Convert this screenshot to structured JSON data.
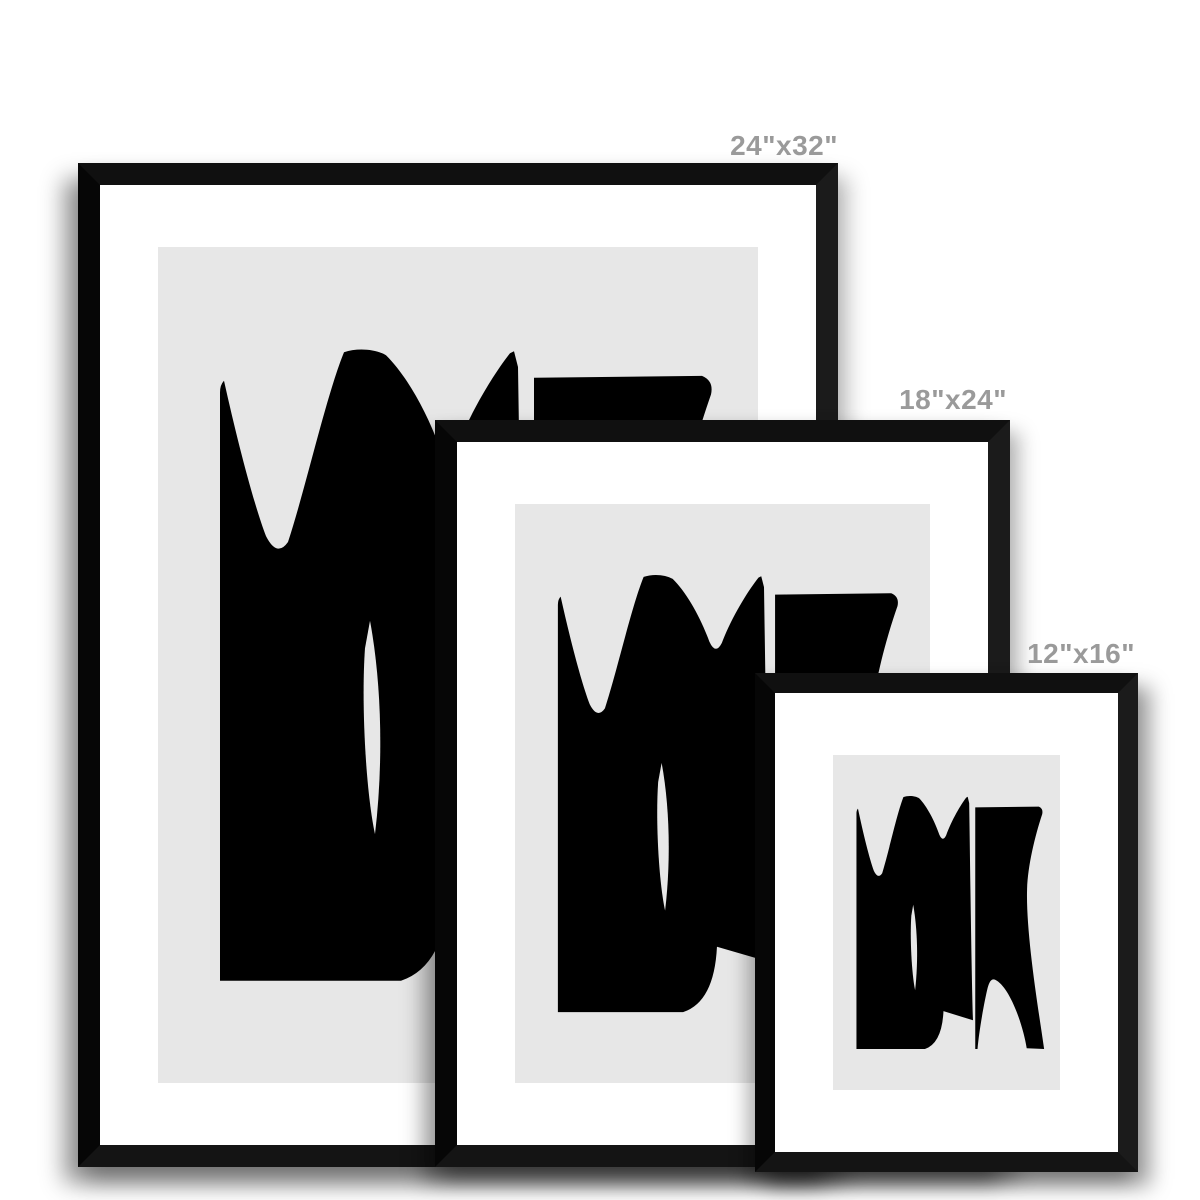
{
  "frames": {
    "large": {
      "size_label": "24\"x32\""
    },
    "medium": {
      "size_label": "18\"x24\""
    },
    "small": {
      "size_label": "12\"x16\""
    }
  },
  "colors": {
    "page_background": "#ffffff",
    "frame": "#0d0d0d",
    "mat": "#ffffff",
    "artwork_background": "#e7e7e7",
    "artwork_shapes": "#000000",
    "label_text": "#9a9a9a"
  }
}
